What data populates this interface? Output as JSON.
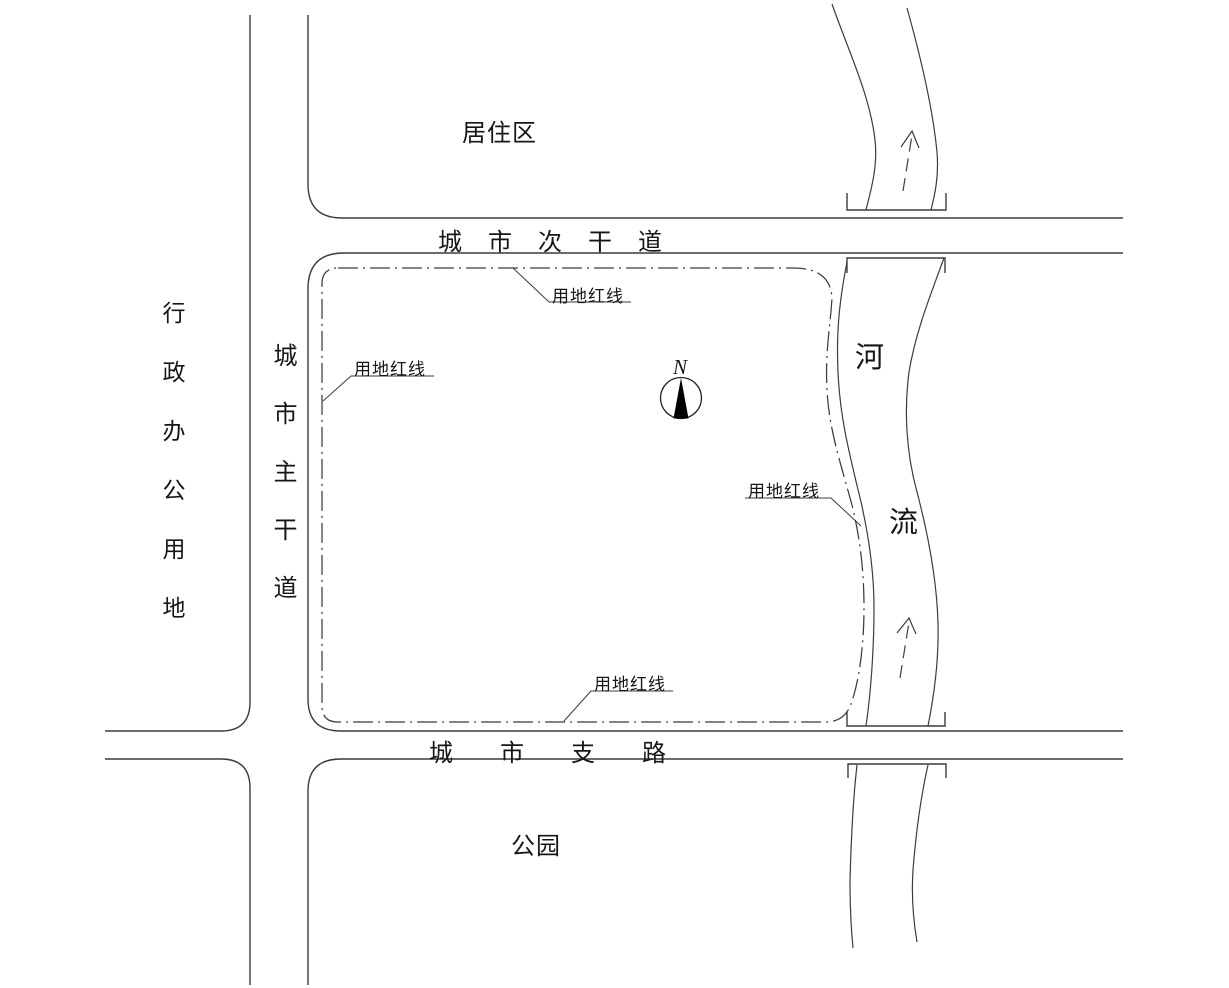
{
  "drawing": {
    "title": "site location plan",
    "background_color": "#ffffff",
    "line_color": "#3c3c3c",
    "text_color": "#161616"
  },
  "areas": {
    "admin_office": "行政办公用地",
    "residential": "居住区",
    "park": "公园"
  },
  "roads": {
    "main": "城市主干道",
    "secondary": "城市次干道",
    "branch": "城市支路"
  },
  "river": {
    "char_top": "河",
    "char_bottom": "流",
    "flow_arrow_direction": "up"
  },
  "site": {
    "boundary_label": "用地红线",
    "boundary_label_count": 4,
    "boundary_line_style": "dash-dot"
  },
  "compass": {
    "label": "N"
  }
}
